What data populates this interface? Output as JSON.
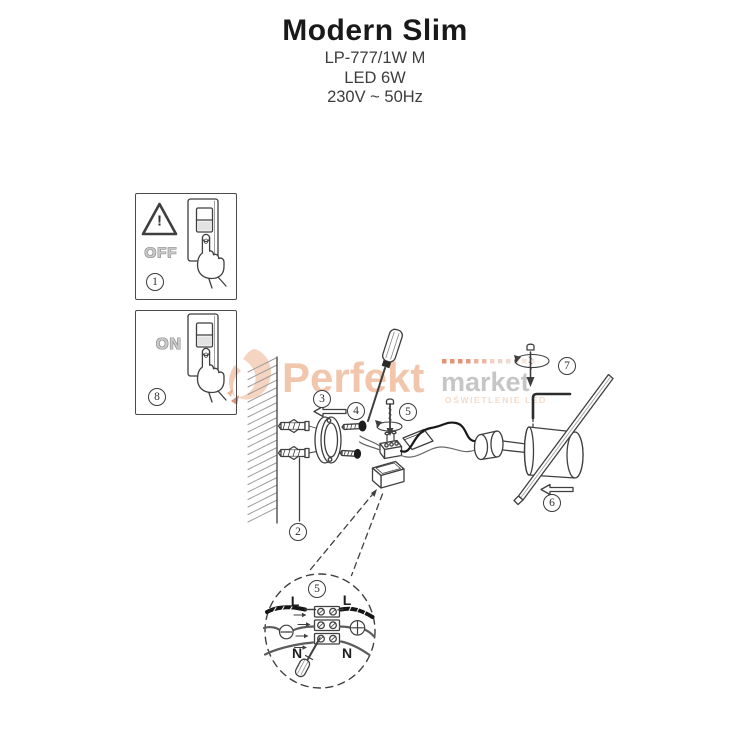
{
  "header": {
    "title": "Modern Slim",
    "model": "LP-777/1W M",
    "lamp_type": "LED 6W",
    "power": "230V ~ 50Hz"
  },
  "watermark": {
    "brand": "Perfekt",
    "brand_suffix": "market",
    "tagline": "OŚWIETLENIE LED",
    "colors": {
      "brand": "#f2c6ad",
      "suffix": "#c6c6c6",
      "dots": "#dd8059",
      "tagline": "#f3dbc9"
    }
  },
  "panel_off": {
    "step": "1",
    "label": "OFF",
    "warning_mark": "!"
  },
  "panel_on": {
    "step": "8",
    "label": "ON"
  },
  "step_labels": {
    "s2": "2",
    "s3": "3",
    "s4": "4",
    "s5": "5",
    "s6": "6",
    "s7": "7"
  },
  "wiring_detail": {
    "step": "5",
    "live_left": "L",
    "live_right": "L",
    "neutral_left": "N",
    "neutral_right": "N"
  },
  "icons": {
    "warning": "triangle-exclamation",
    "rotation": "circular-arrow",
    "polarity_left": "minus-circle",
    "polarity_right": "plus-circle",
    "tools": [
      "screwdriver",
      "allen-key",
      "wall-plug"
    ]
  },
  "colors": {
    "line_art": "#3f3f3f",
    "wire_dark": "#161616",
    "background": "#ffffff"
  }
}
